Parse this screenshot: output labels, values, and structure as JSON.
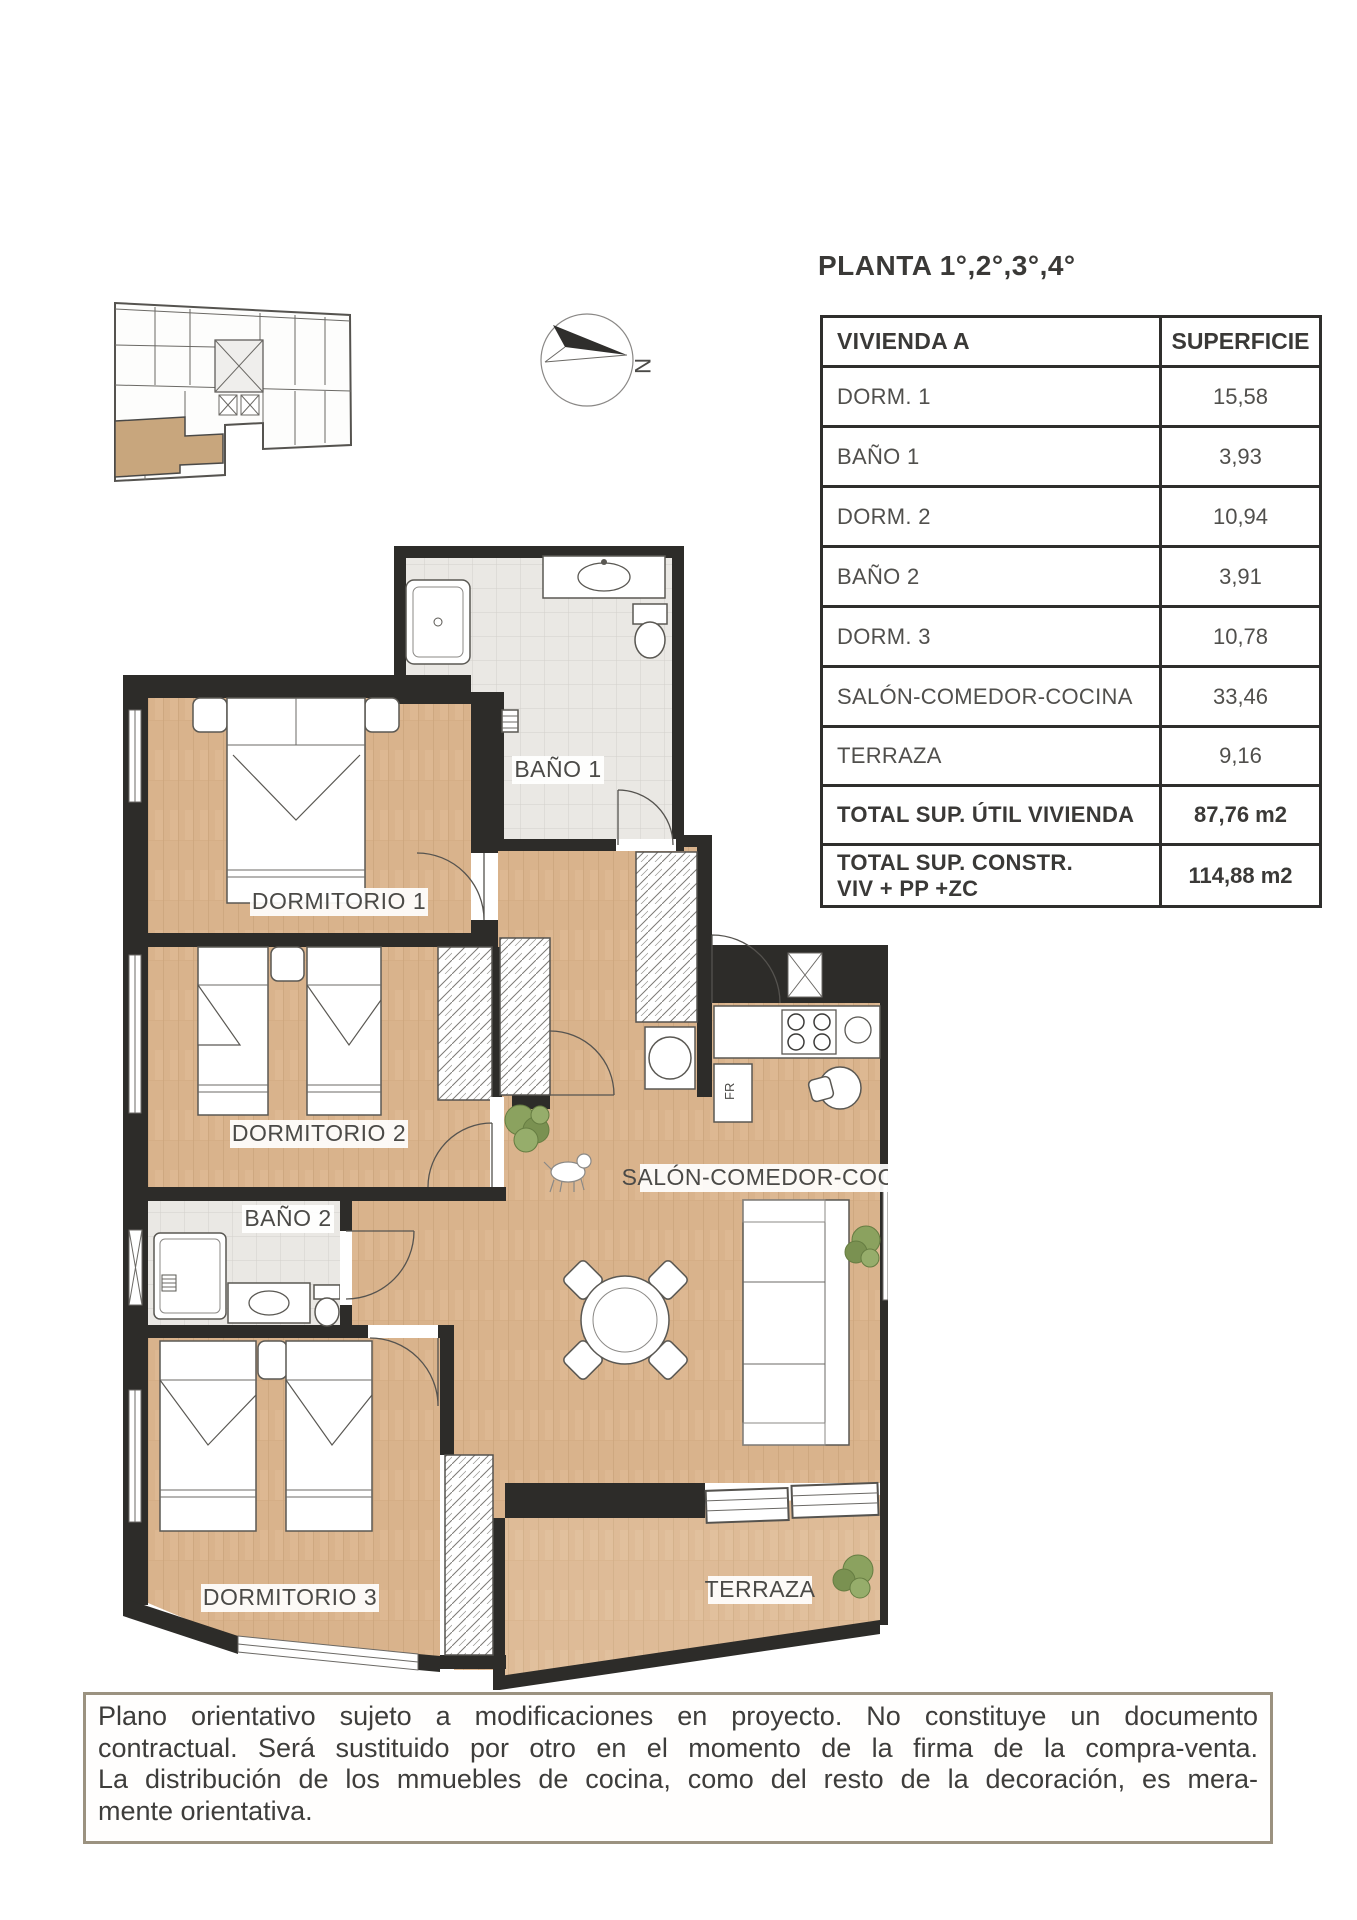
{
  "title": "PLANTA 1°,2°,3°,4°",
  "compass": {
    "north_label": "N"
  },
  "table": {
    "headers": {
      "unit": "VIVIENDA A",
      "area": "SUPERFICIE"
    },
    "rows": [
      {
        "label": "DORM. 1",
        "value": "15,58"
      },
      {
        "label": "BAÑO 1",
        "value": "3,93"
      },
      {
        "label": "DORM. 2",
        "value": "10,94"
      },
      {
        "label": "BAÑO 2",
        "value": "3,91"
      },
      {
        "label": "DORM. 3",
        "value": "10,78"
      },
      {
        "label": "SALÓN-COMEDOR-COCINA",
        "value": "33,46"
      },
      {
        "label": "TERRAZA",
        "value": "9,16"
      }
    ],
    "totals": [
      {
        "label": "TOTAL SUP. ÚTIL VIVIENDA",
        "value": "87,76 m2"
      },
      {
        "label": "TOTAL SUP. CONSTR.\nVIV + PP +ZC",
        "value": "114,88 m2"
      }
    ]
  },
  "plan": {
    "labels": {
      "dormitorio1": "DORMITORIO 1",
      "bano1": "BAÑO 1",
      "dormitorio2": "DORMITORIO 2",
      "bano2": "BAÑO 2",
      "dormitorio3": "DORMITORIO 3",
      "salon": "SALÓN-COMEDOR-COCINA",
      "terraza": "TERRAZA",
      "fridge": "FR"
    }
  },
  "disclaimer_lines": [
    "Plano orientativo sujeto a modificaciones en proyecto. No constituye un documento",
    "contractual. Será sustituido por otro en el momento de la firma de la compra-venta.",
    "La distribución de los mmuebles de cocina, como del resto de la decoración, es mera-",
    "mente orientativa."
  ],
  "colors": {
    "wall": "#2d2c29",
    "wood_floor": "#d9b38c",
    "terrace_floor": "#debb97",
    "tile_floor": "#eae8e4",
    "highlight_unit": "#c8a67d",
    "table_border": "#2f2e2c",
    "disclaimer_border": "#9b9280"
  }
}
